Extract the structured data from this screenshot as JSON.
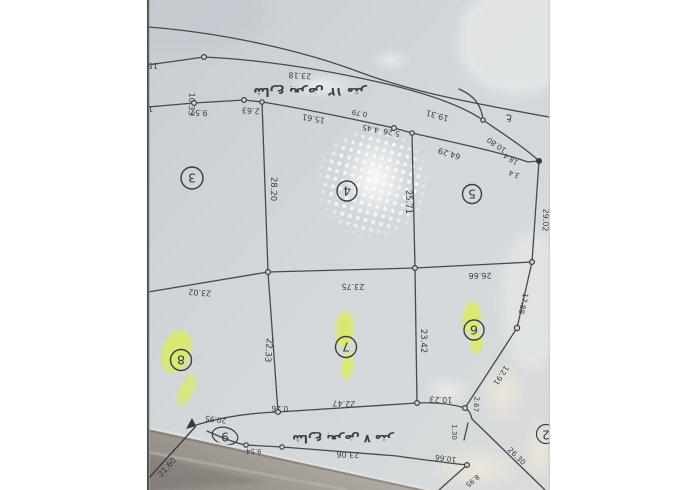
{
  "viewer": {
    "background": "#ffffff",
    "content": "photographed survey plat, rotated 180°"
  },
  "photo": {
    "paper_color": "#d2d6d9",
    "line_color": "#47484b",
    "highlight_color": "#dcee55",
    "streets": {
      "top": "شارع بعرض ١٢ متر",
      "bottom": "شارع بعرض ٧ متر"
    },
    "plots": {
      "row_upper": [
        "3",
        "4",
        "5"
      ],
      "row_lower": [
        "8",
        "7",
        "6"
      ],
      "below_street": "9",
      "edge_partial": "2",
      "highlighted": [
        "8",
        "7",
        "6"
      ]
    },
    "dims": {
      "frag15": "15",
      "d23_18": "23.18",
      "d10_33": "10.33",
      "frag1": "1",
      "d9_57": "9.57",
      "d2_63": "2.63",
      "d15_61": "15.61",
      "d0_79": "0.79",
      "d4_45": "4.45",
      "d5_26": "5.26",
      "d19_31": "19.31",
      "d64_29": "64.29",
      "d10_80": "10.80",
      "d18_4": "18.4",
      "d3_4": "3.4",
      "ain": "ع",
      "d28_20": "28.20",
      "d25_71": "25.71",
      "d29_02": "29.02",
      "d23_02": "23.02",
      "d23_75": "23.75",
      "d26_66": "26.66",
      "d17_88": "17.88",
      "d22_33": "22.33",
      "d23_42": "23.42",
      "d12_91": "12.91",
      "d20_95": "20.95",
      "d0_26": "0.26",
      "d22_47": "22.47",
      "d10_23": "10.23",
      "d2_67": "2.67",
      "d1_30": "1.30",
      "d26_30": "26.30",
      "d21_60": "21.60",
      "d9_54": "9.54",
      "d23_06": "23.06",
      "d10_66": "10.66",
      "d8_95": "8.95"
    }
  }
}
